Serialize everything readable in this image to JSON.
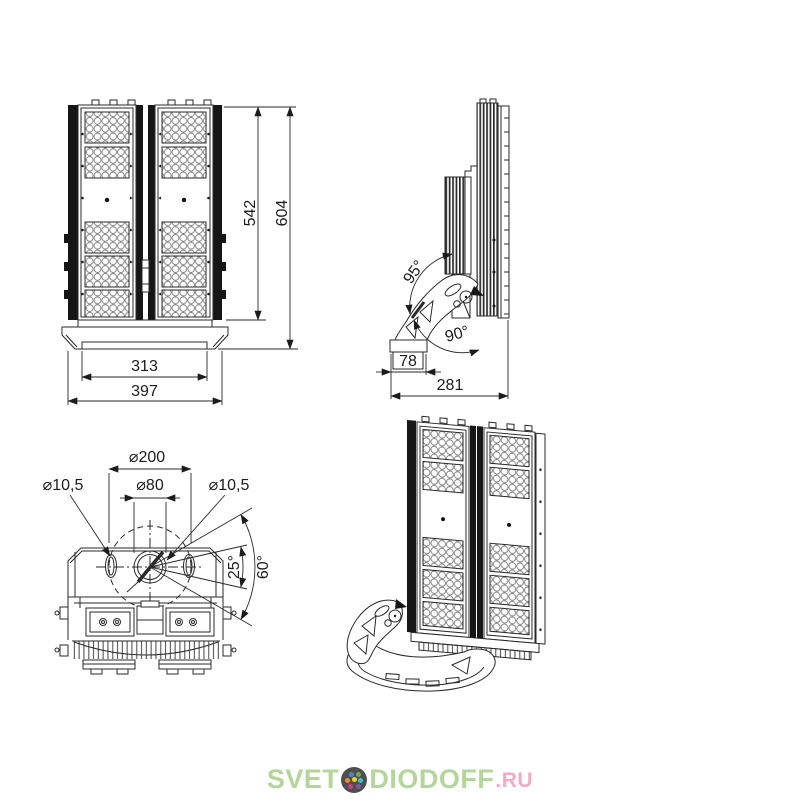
{
  "page": {
    "background": "#ffffff"
  },
  "brand": {
    "word_left": "SVET",
    "word_right": "DIODOFF",
    "tld": ".RU",
    "green": "#b4d69b",
    "pink": "#f3aac5",
    "disc_color": "#4f4f4f",
    "dot_colors": [
      "#4f86c6",
      "#6fae44",
      "#ef8b33",
      "#43bfd0",
      "#f0d12b",
      "#d8388a",
      "#7b5aa6"
    ]
  },
  "views": {
    "front": {
      "label": "front view",
      "dims": {
        "inner_height": "542",
        "total_height": "604",
        "inner_width": "313",
        "total_width": "397"
      }
    },
    "side": {
      "label": "side view",
      "dims": {
        "tilt_back": "95°",
        "tilt_forward": "90°",
        "foot_depth": "78",
        "total_depth": "281"
      }
    },
    "top": {
      "label": "mounting bracket view",
      "dims": {
        "bolt_circle": "⌀200",
        "slot_left": "⌀10,5",
        "center_hole": "⌀80",
        "slot_right": "⌀10,5",
        "swivel_minor": "25°",
        "swivel_major": "60°"
      }
    },
    "iso": {
      "label": "isometric view"
    }
  }
}
